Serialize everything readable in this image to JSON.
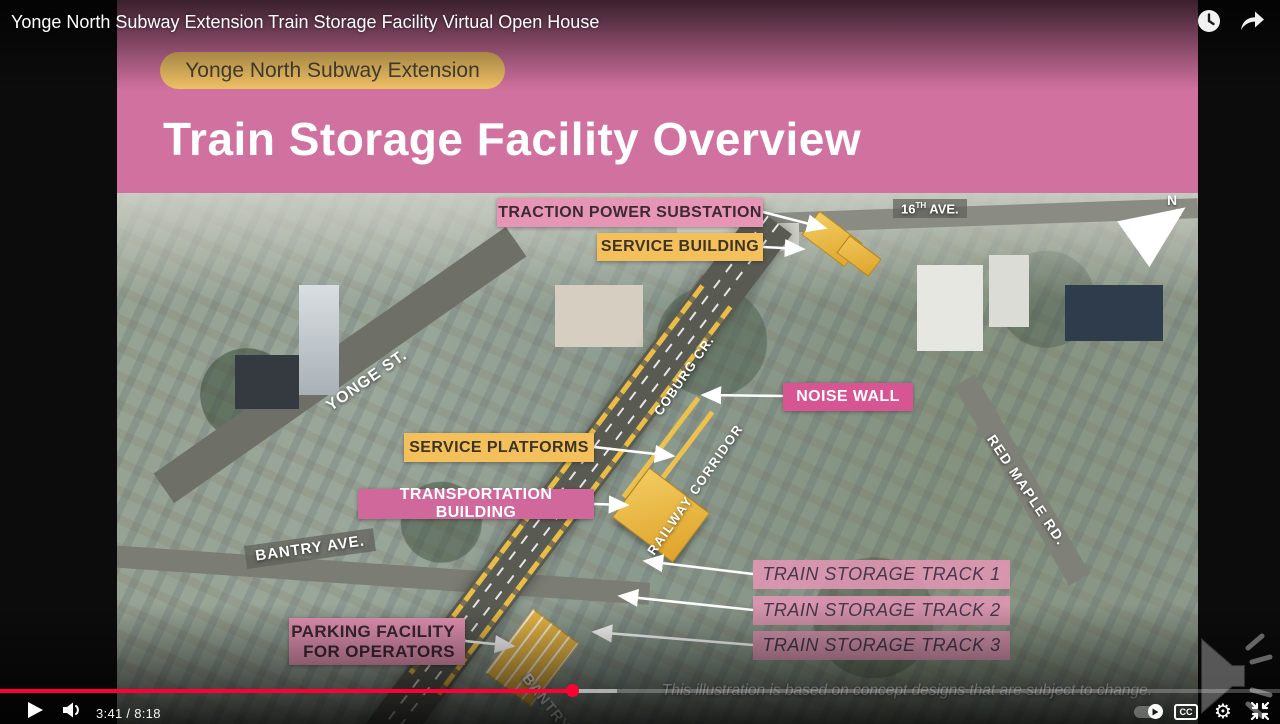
{
  "player": {
    "title": "Yonge North Subway Extension Train Storage Facility Virtual Open House",
    "time_display": "3:41 / 8:18",
    "current_time": "3:41",
    "duration": "8:18",
    "progress_percent": 44.7,
    "cc_label": "CC",
    "colors": {
      "progress_red": "#ff0033"
    }
  },
  "slide": {
    "badge": "Yonge North Subway Extension",
    "title": "Train Storage Facility Overview",
    "compass": "N",
    "disclaimer": "This illustration is based on concept designs that are subject to change.",
    "colors": {
      "header_pink": "#d0719f",
      "badge_yellow": "#f0c264",
      "label_yellow": "#f3c05c",
      "label_pink_light": "#e795b5",
      "label_magenta": "#d75593",
      "label_pink": "#d0689c",
      "track_bar_pink": "#e296b6",
      "facility_yellow": "#e9b845"
    },
    "facility_labels": {
      "traction_power_substation": "TRACTION POWER SUBSTATION",
      "service_building": "SERVICE BUILDING",
      "noise_wall": "NOISE WALL",
      "service_platforms": "SERVICE PLATFORMS",
      "transportation_building": "TRANSPORTATION BUILDING",
      "parking_facility": "PARKING FACILITY FOR OPERATORS"
    },
    "street_labels": {
      "sixteenth_ave": {
        "num": "16",
        "sup": "TH",
        "rest": " AVE."
      },
      "yonge_st": "YONGE ST.",
      "coburg_cr": "COBURG CR.",
      "railway_corridor": "RAILWAY CORRIDOR",
      "bantry_ave": "BANTRY AVE.",
      "red_maple_rd": "RED MAPLE RD.",
      "bantry_bottom": "BANTRY"
    },
    "tracks": [
      "TRAIN STORAGE TRACK 1",
      "TRAIN STORAGE TRACK 2",
      "TRAIN STORAGE TRACK 3"
    ]
  }
}
